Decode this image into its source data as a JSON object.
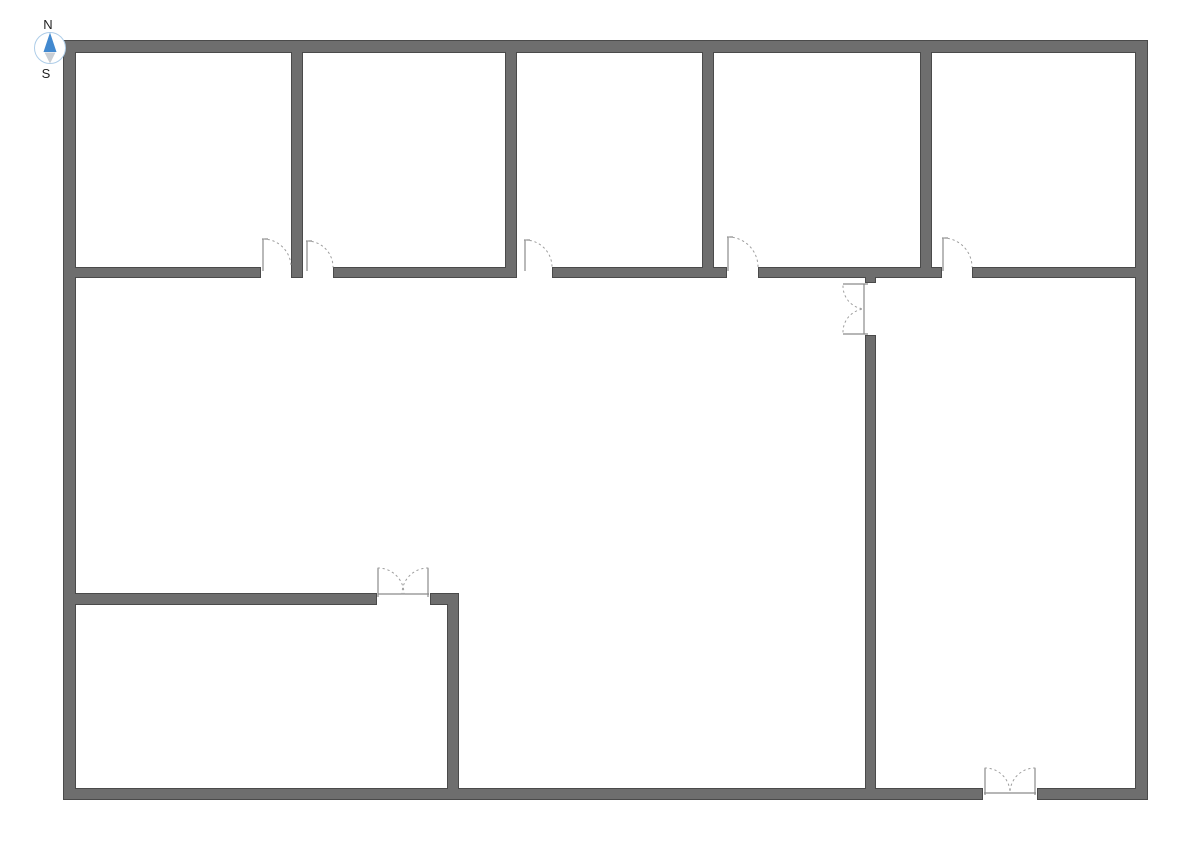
{
  "canvas": {
    "width": 1191,
    "height": 841,
    "background": "#ffffff"
  },
  "colors": {
    "wall_fill": "#6e6e6e",
    "wall_stroke": "#4a4a4a",
    "door_line": "#8a8a8a",
    "swing": "#9e9e9e",
    "threshold_fill": "#ffffff",
    "compass_ring": "#aecde8",
    "compass_north": "#4289cf",
    "compass_south": "#c9ced4",
    "compass_label": "#222222"
  },
  "compass": {
    "cx": 50,
    "cy": 48,
    "r": 15.5,
    "labels": {
      "north": "N",
      "south": "S"
    }
  },
  "walls": [
    {
      "name": "exterior-wall-top",
      "x": 63,
      "y": 40,
      "w": 1085,
      "h": 13
    },
    {
      "name": "exterior-wall-left",
      "x": 63,
      "y": 40,
      "w": 13,
      "h": 760
    },
    {
      "name": "exterior-wall-right",
      "x": 1135,
      "y": 40,
      "w": 13,
      "h": 760
    },
    {
      "name": "exterior-wall-bottom-left",
      "x": 63,
      "y": 788,
      "w": 920,
      "h": 12
    },
    {
      "name": "exterior-wall-bottom-right",
      "x": 1037,
      "y": 788,
      "w": 111,
      "h": 12
    },
    {
      "name": "top-rooms-divider-1",
      "x": 291,
      "y": 40,
      "w": 12,
      "h": 238
    },
    {
      "name": "top-rooms-divider-2",
      "x": 505,
      "y": 40,
      "w": 12,
      "h": 238
    },
    {
      "name": "top-rooms-divider-3",
      "x": 702,
      "y": 40,
      "w": 12,
      "h": 238
    },
    {
      "name": "top-rooms-divider-4",
      "x": 920,
      "y": 40,
      "w": 12,
      "h": 238
    },
    {
      "name": "corridor-wall-segment-1",
      "x": 63,
      "y": 267,
      "w": 198,
      "h": 11
    },
    {
      "name": "corridor-wall-segment-2",
      "x": 333,
      "y": 267,
      "w": 184,
      "h": 11
    },
    {
      "name": "corridor-wall-segment-3",
      "x": 552,
      "y": 267,
      "w": 175,
      "h": 11
    },
    {
      "name": "corridor-wall-segment-4",
      "x": 758,
      "y": 267,
      "w": 184,
      "h": 11
    },
    {
      "name": "corridor-wall-segment-5",
      "x": 972,
      "y": 267,
      "w": 176,
      "h": 11
    },
    {
      "name": "center-vertical-wall-stub",
      "x": 865,
      "y": 267,
      "w": 11,
      "h": 16
    },
    {
      "name": "center-vertical-wall",
      "x": 865,
      "y": 335,
      "w": 11,
      "h": 465
    },
    {
      "name": "bottom-left-room-top-wall",
      "x": 63,
      "y": 593,
      "w": 314,
      "h": 12
    },
    {
      "name": "bottom-left-room-top-wall-right",
      "x": 430,
      "y": 593,
      "w": 29,
      "h": 12
    },
    {
      "name": "bottom-left-room-right-wall",
      "x": 447,
      "y": 593,
      "w": 12,
      "h": 207
    }
  ],
  "single_doors": [
    {
      "name": "room-1-door",
      "hinge_x": 263,
      "wall_y": 267,
      "radius": 28
    },
    {
      "name": "room-2-door",
      "hinge_x": 307,
      "wall_y": 267,
      "radius": 26
    },
    {
      "name": "room-3-door",
      "hinge_x": 525,
      "wall_y": 267,
      "radius": 27
    },
    {
      "name": "room-4-door",
      "hinge_x": 728,
      "wall_y": 267,
      "radius": 30
    },
    {
      "name": "room-5-door",
      "hinge_x": 943,
      "wall_y": 267,
      "radius": 29
    }
  ],
  "double_doors": [
    {
      "name": "center-wall-double-door",
      "threshold": {
        "x": 864,
        "y": 284,
        "w": 13,
        "h": 50
      },
      "lines": [
        [
          843,
          284,
          868,
          284
        ],
        [
          843,
          334,
          868,
          334
        ],
        [
          864,
          284,
          864,
          334
        ]
      ],
      "arcs": [
        "M 843 286 A 23 23 0 0 0 864 309",
        "M 843 332 A 23 23 0 0 1 864 309"
      ]
    },
    {
      "name": "bottom-left-room-double-door",
      "threshold": {
        "x": 377,
        "y": 593,
        "w": 53,
        "h": 12
      },
      "lines": [
        [
          378,
          594,
          429,
          594
        ],
        [
          378,
          568,
          378,
          597
        ],
        [
          428,
          568,
          428,
          597
        ]
      ],
      "arcs": [
        "M 378 568 A 26 26 0 0 1 404 594",
        "M 428 568 A 26 26 0 0 0 402 594"
      ]
    },
    {
      "name": "bottom-exterior-double-door",
      "threshold": {
        "x": 983,
        "y": 788,
        "w": 54,
        "h": 12
      },
      "lines": [
        [
          984,
          793,
          1036,
          793
        ],
        [
          985,
          768,
          985,
          795
        ],
        [
          1035,
          768,
          1035,
          795
        ]
      ],
      "arcs": [
        "M 985 768 A 25 25 0 0 1 1010 793",
        "M 1035 768 A 25 25 0 0 0 1010 793"
      ]
    }
  ]
}
